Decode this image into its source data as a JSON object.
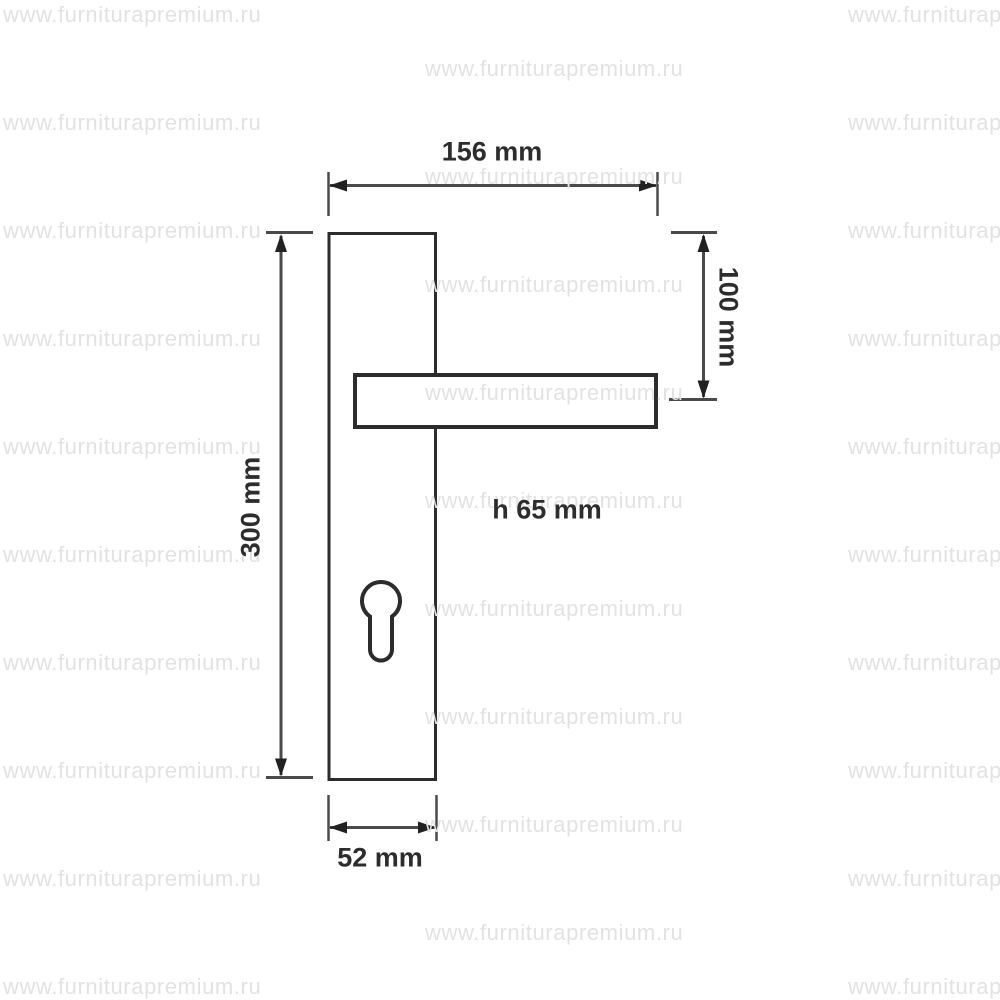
{
  "page": {
    "background_color": "#ffffff",
    "description_labels_color": "#2d2d2d"
  },
  "watermark": {
    "text": "www.furniturapremium.ru",
    "color": "#e2e2e2",
    "columns_x": [
      3,
      425,
      848
    ],
    "row_start_y": 15,
    "row_step_y": 54,
    "row_count": 19
  },
  "diagram": {
    "type": "door-handle-technical-drawing",
    "line_color": "#2c2c2c",
    "dim_color": "#4a4a4a",
    "labels": {
      "total_width": "156 mm",
      "plate_height": "300 mm",
      "handle_offset": "100 mm",
      "handle_height": "h 65 mm",
      "plate_width": "52 mm"
    }
  }
}
